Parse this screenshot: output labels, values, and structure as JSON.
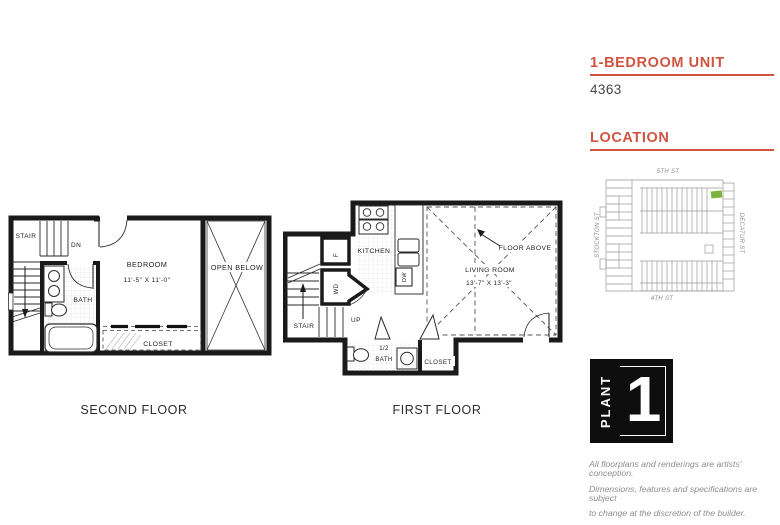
{
  "page": {
    "background": "#ffffff",
    "accent": "#d15440"
  },
  "second_floor": {
    "caption": "SECOND FLOOR",
    "labels": {
      "stair": "STAIR",
      "dn": "DN",
      "bath": "BATH",
      "bedroom": "BEDROOM",
      "bedroom_dim": "11'-5\" X 11'-0\"",
      "closet": "CLOSET",
      "open_below": "OPEN BELOW"
    }
  },
  "first_floor": {
    "caption": "FIRST FLOOR",
    "labels": {
      "kitchen": "KITCHEN",
      "fridge": "F",
      "washer_dryer": "WD",
      "dishwasher": "DW",
      "stair": "STAIR",
      "up": "UP",
      "living_room": "LIVING ROOM",
      "living_dim": "13'-7\" X 13'-3\"",
      "floor_above": "FLOOR ABOVE",
      "half_bath_line1": "1/2",
      "half_bath_line2": "BATH",
      "closet": "CLOSET"
    }
  },
  "sidebar": {
    "unit_heading": "1-BEDROOM UNIT",
    "unit_number": "4363",
    "location_heading": "LOCATION",
    "map": {
      "street_top": "5TH ST",
      "street_bottom": "4TH ST",
      "street_left": "STOCKTON ST",
      "street_right": "DECATUR ST",
      "highlight_color": "#7ab43c"
    },
    "logo": {
      "word": "PLANT",
      "number": "1"
    },
    "disclaimer_lines": [
      "All floorplans and renderings are artists’ conception.",
      "Dimensions, features and specifications are subject",
      "to change at the discretion of the builder."
    ]
  }
}
